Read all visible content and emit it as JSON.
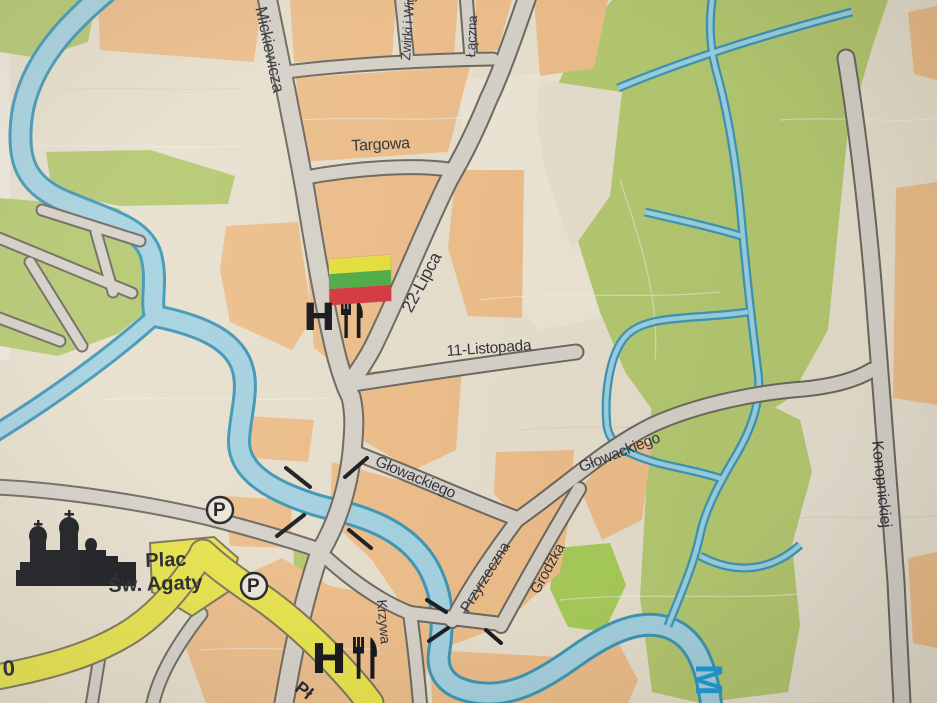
{
  "map": {
    "street_labels": [
      {
        "id": "mickiewicza",
        "name": "Mickiewicza"
      },
      {
        "id": "zwirki",
        "name": "Żwirki i Wig"
      },
      {
        "id": "laczna",
        "name": "Łączna"
      },
      {
        "id": "targowa",
        "name": "Targowa"
      },
      {
        "id": "lipca22",
        "name": "22-Lipca"
      },
      {
        "id": "listopada11",
        "name": "11-Listopada"
      },
      {
        "id": "glowackiego_w",
        "name": "Głowackiego"
      },
      {
        "id": "glowackiego_e",
        "name": "Głowackiego"
      },
      {
        "id": "przyrzeczna",
        "name": "Przyrzeczna"
      },
      {
        "id": "grodzka",
        "name": "Grodźka"
      },
      {
        "id": "krzywa",
        "name": "Krzywa"
      },
      {
        "id": "konopnickiej",
        "name": "Konopnickiej"
      }
    ],
    "place_labels": {
      "plac_line1": "Plac",
      "plac_line2": "Św. Agaty"
    },
    "fragments": {
      "road_number": "0",
      "yellow_road_name": "Pł",
      "river_name_initial": "M"
    },
    "poi": {
      "hotel_letter": "H",
      "parking_letter": "P",
      "hotel_icon": "hotel-icon",
      "restaurant_icon": "fork-knife-icon",
      "church_icon": "church-silhouette-icon",
      "parking_icon": "parking-icon",
      "flag_icon": "lithuanian-flag-marker"
    },
    "palette": {
      "background_cream": "#eae2d0",
      "block_orange": "#f0c08c",
      "park_green": "#b7cb72",
      "park_green_bright": "#aace5c",
      "water_fill": "#a7d4e3",
      "water_edge": "#3f99b8",
      "road_fill": "#d8d4cb",
      "road_casing": "#6e6a60",
      "main_road_yellow": "#ebe74d",
      "flag_yellow": "#e7e33d",
      "flag_green": "#4fae47",
      "flag_red": "#d73840",
      "river_label_blue": "#1f9ed8",
      "poi_black": "#14161c"
    }
  }
}
